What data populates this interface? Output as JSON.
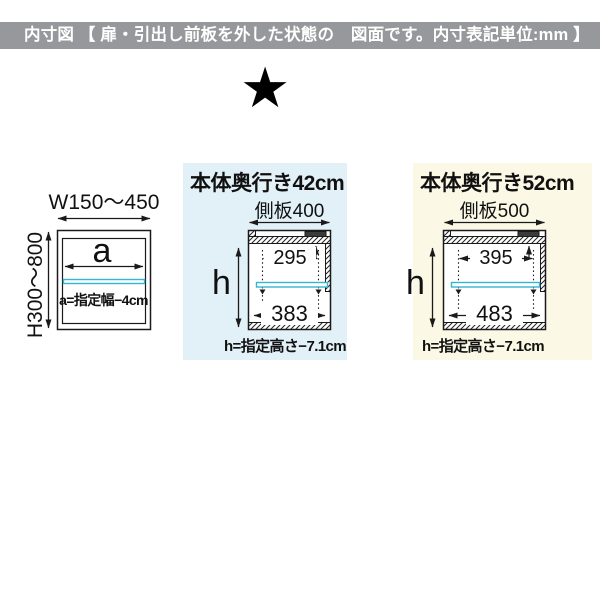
{
  "header": {
    "title": "内寸図 【 扉・引出し前板を外した状態の　図面です。内寸表記単位:mm 】"
  },
  "star_icon": "★",
  "front_view": {
    "width_range": "W150〜450",
    "height_range": "H300〜800",
    "inner_width_var": "a",
    "inner_width_note": "a=指定幅−4cm"
  },
  "depth_42": {
    "title": "本体奥行き42cm",
    "side_panel": "側板400",
    "upper_inner_depth": "295",
    "lower_inner_depth": "383",
    "inner_height_var": "h",
    "inner_height_note": "h=指定高さ−7.1cm"
  },
  "depth_52": {
    "title": "本体奥行き52cm",
    "side_panel": "側板500",
    "upper_inner_depth": "395",
    "lower_inner_depth": "483",
    "inner_height_var": "h",
    "inner_height_note": "h=指定高さ−7.1cm"
  },
  "colors": {
    "header_bg": "#97989b",
    "header_text": "#ffffff",
    "panel_depth42_bg": "#e2f1f8",
    "panel_depth52_bg": "#fbf8e6",
    "shelf_accent": "#35b6cf",
    "line": "#1a1a1a"
  }
}
